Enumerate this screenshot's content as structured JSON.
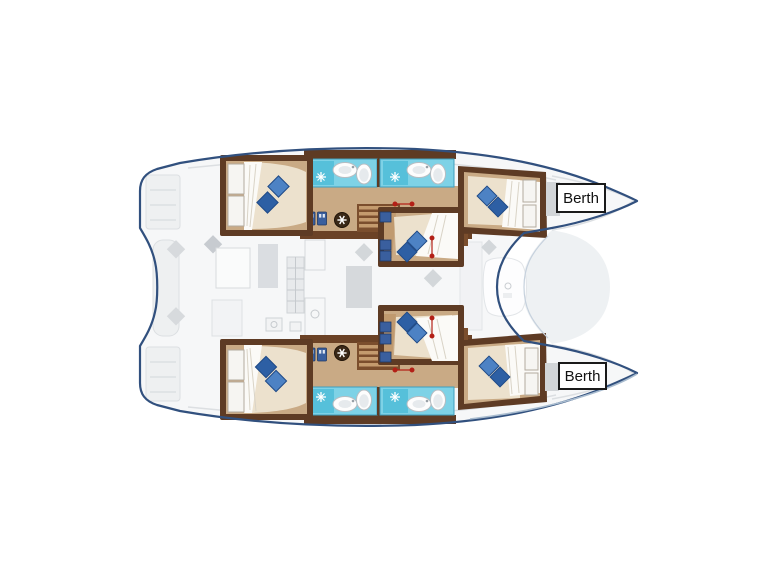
{
  "labels": {
    "berth_top": "Berth",
    "berth_bottom": "Berth"
  },
  "areas": [
    "stern-swim-platforms",
    "cockpit",
    "salon-galley",
    "port-aft-cabin",
    "port-bathroom",
    "port-forward-cabin",
    "upper-mid-cabin",
    "lower-mid-cabin",
    "starboard-aft-cabin",
    "starboard-bathroom",
    "starboard-forward-cabin",
    "foredeck-trampoline"
  ],
  "colors": {
    "hull_outline": "#31507e",
    "deck": "#f6f7f8",
    "wood_dark": "#5e3b24",
    "wood_mid": "#7b4e2d",
    "floor_tan": "#c9aa85",
    "mattress": "#ece1cd",
    "duvet": "#fbfaf7",
    "bath_cyan": "#7ed2e6",
    "bath_pane": "#56c0da",
    "pillow_light": "#4d82c4",
    "pillow_dark": "#2d5fa4",
    "locker_blue": "#3a5f9e",
    "marker_red": "#b32017",
    "label_border": "#1a1a1a",
    "label_bg": "#ffffff",
    "label_text": "#111111"
  }
}
